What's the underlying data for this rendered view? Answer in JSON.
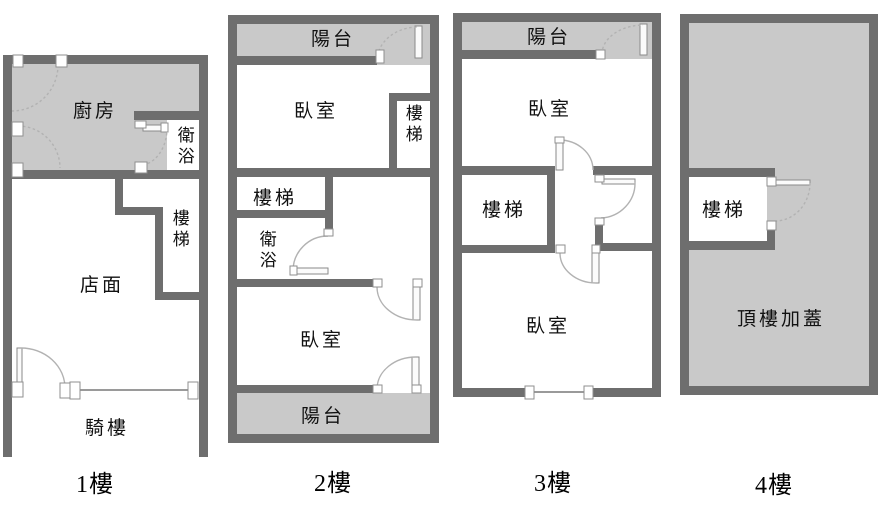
{
  "diagram_type": "real-estate multi-floor plan",
  "colors": {
    "wall": "#6e6e6e",
    "shaded_area": "#c9c9c9",
    "door_arc": "#b2b2b2",
    "window_line": "#9a9a9a",
    "text": "#000000",
    "background": "#ffffff"
  },
  "floors": [
    {
      "caption": "1樓",
      "rooms": {
        "kitchen": "廚房",
        "bath": "衛浴",
        "stairs": "樓梯",
        "store": "店面",
        "arcade": "騎樓"
      }
    },
    {
      "caption": "2樓",
      "rooms": {
        "balcony_top": "陽台",
        "bedroom_top": "臥室",
        "stairs_right": "樓梯",
        "stairs_left": "樓梯",
        "bath": "衛浴",
        "bedroom_bottom": "臥室",
        "balcony_bottom": "陽台"
      }
    },
    {
      "caption": "3樓",
      "rooms": {
        "balcony": "陽台",
        "bedroom_top": "臥室",
        "stairs": "樓梯",
        "bedroom_bottom": "臥室"
      }
    },
    {
      "caption": "4樓",
      "rooms": {
        "stairs": "樓梯",
        "rooftop": "頂樓加蓋"
      }
    }
  ]
}
